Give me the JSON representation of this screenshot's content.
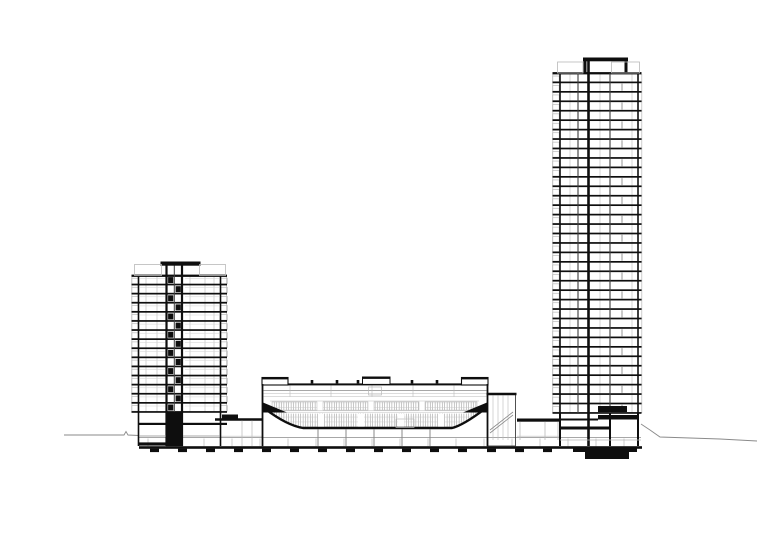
{
  "document": {
    "type": "architectural-cross-section",
    "description": "Black line architectural section drawing: a 15-storey residential tower (left) and a 36-storey residential tower (right) flanking a central arena auditorium with raked seating bowl, all on a shared podium with basement levels and footings; thin grade lines extend left and right.",
    "background": "#ffffff"
  },
  "palette": {
    "ink": "#0e0e0e",
    "dark": "#3d3d3d",
    "medium": "#8a8a8a",
    "light": "#b9b9b9",
    "faint": "#d2d2d2",
    "paper": "#ffffff"
  },
  "canvas": {
    "width": 780,
    "height": 546
  },
  "drawing": {
    "ground_left": {
      "points": [
        [
          64,
          435
        ],
        [
          100,
          435
        ],
        [
          124,
          435
        ],
        [
          126,
          431.5
        ],
        [
          128,
          435
        ],
        [
          139,
          435.5
        ]
      ]
    },
    "ground_right": {
      "points": [
        [
          641,
          424
        ],
        [
          650,
          430
        ],
        [
          660,
          437
        ],
        [
          690,
          438
        ],
        [
          720,
          439
        ],
        [
          757,
          441
        ]
      ]
    },
    "foundation": {
      "basement_line": [
        139,
        437.5,
        641,
        437.5
      ],
      "slab": [
        139,
        446.2,
        503,
        2.6
      ],
      "footing_xs": [
        150,
        178,
        206,
        234,
        262,
        290,
        318,
        346,
        374,
        402,
        430,
        458,
        487,
        515,
        543
      ],
      "footing_y": 448.6,
      "footing_w": 9,
      "footing_h": 3.5,
      "column_xs": [
        148,
        176,
        204,
        232,
        260,
        288,
        316,
        344,
        372,
        400,
        428,
        456,
        484,
        512,
        540,
        568,
        596,
        624
      ],
      "column_top": 438.5,
      "column_bot": 446.2
    },
    "left_tower": {
      "wall_l": 138.5,
      "wall_r": 220.5,
      "slab_x1": 131.5,
      "slab_x2": 227,
      "roof_y": 275.5,
      "base_y": 412,
      "floors": 15,
      "guard_x": [
        131.9,
        226.5
      ],
      "balcony_box": {
        "w": 6.6,
        "h": 5.6,
        "lx": 131.7,
        "rx": 220.7
      },
      "core": {
        "x1": 166.5,
        "x2": 182,
        "mid": 174.3,
        "top_y": 261.5,
        "cap": [
          160.5,
          261.5,
          40,
          4.2
        ]
      },
      "parapets": [
        [
          134.5,
          264.5,
          27,
          11
        ],
        [
          199.5,
          264.5,
          26,
          11
        ]
      ],
      "mullions": [
        146,
        157,
        190,
        205,
        214
      ],
      "window_line": {
        "x1": 185,
        "x2": 219,
        "dy": 3.1
      },
      "mezz_slab": [
        139,
        422.8,
        88,
        2.2
      ],
      "ground_line": [
        139,
        436,
        220,
        436
      ],
      "base_core_block": [
        166,
        412,
        17,
        34.2
      ],
      "base_slab_block": [
        139,
        442.4,
        33,
        3.2
      ]
    },
    "right_tower": {
      "wall_l": 560,
      "wall_r": 638,
      "slab_x1": 552.5,
      "slab_x2": 641.5,
      "roof_y": 73,
      "base_y": 413,
      "floors": 36,
      "guard_x": [
        552.8,
        641.8
      ],
      "balcony_box": {
        "w": 6.6,
        "h": 5.6,
        "lx": 552.6
      },
      "core_x": 588.5,
      "walls_thin": [
        578,
        610
      ],
      "mullions": [
        570,
        600,
        632
      ],
      "segment_wall_x": 622,
      "core_cap": [
        583,
        57.5,
        45,
        3.8
      ],
      "cap_posts": [
        [
          583.5,
          61,
          3,
          12
        ],
        [
          624.5,
          61,
          3,
          12
        ]
      ],
      "parapets": [
        [
          557.5,
          62,
          25.5,
          11
        ],
        [
          611.5,
          62,
          28,
          11
        ]
      ],
      "base": {
        "chunk1": [
          598,
          406,
          29,
          6
        ],
        "chunk2": [
          598,
          415,
          40,
          4.5
        ],
        "lowband": [
          560,
          426.5,
          50,
          3
        ],
        "edge_line": [
          560,
          419.5,
          598,
          419.5
        ],
        "walls_x": [
          560,
          588.5,
          610,
          638
        ],
        "ground_line": [
          560,
          440,
          641,
          440
        ]
      },
      "mats": {
        "outer": [
          573,
          446.5,
          64,
          5.5
        ],
        "inner": [
          585,
          451.5,
          44,
          7.5
        ]
      }
    },
    "arena": {
      "wall_l": 262.5,
      "wall_r": 487.5,
      "wall_top": 384,
      "wall_bot": 446.2,
      "roof_slab": [
        262,
        383.4,
        226,
        2
      ],
      "blocks": [
        [
          262,
          377.5,
          26,
          7.5
        ],
        [
          461.5,
          377.5,
          26.5,
          7.5
        ]
      ],
      "monitor": [
        362.5,
        377,
        27.5,
        7.4
      ],
      "monitor_box": [
        368.5,
        387,
        13,
        8
      ],
      "posts": [
        312,
        337,
        358,
        412,
        437
      ],
      "post_w": 2.6,
      "post_h": 3.4,
      "ceiling_ys": [
        390.5,
        393.4,
        396.6
      ],
      "hanger_xs": [
        290,
        331,
        372,
        413,
        454
      ],
      "tier": {
        "y": 401.8,
        "h": 8.3,
        "segments": [
          [
            272,
            317
          ],
          [
            323,
            368
          ],
          [
            374,
            419
          ],
          [
            425,
            477
          ]
        ]
      },
      "gallery_y": 412.2,
      "bowl": {
        "x1": 265,
        "x2": 485,
        "top_y": 408,
        "shelf_y": 413.6,
        "floor_y": 427.6,
        "floor_x1": 303,
        "floor_x2": 452
      },
      "vomitories": [
        318,
        358,
        398,
        438
      ],
      "wedges": [
        [
          [
            263,
            402.5
          ],
          [
            287,
            412.5
          ],
          [
            263,
            412.5
          ]
        ],
        [
          [
            487,
            402.5
          ],
          [
            463,
            412.5
          ],
          [
            487,
            412.5
          ]
        ]
      ],
      "floor_box": [
        396,
        419,
        18,
        8.4
      ],
      "under_cols": [
        318,
        346,
        374,
        402,
        430
      ]
    },
    "podium": {
      "left_roof": [
        215,
        419.5,
        263,
        419.5
      ],
      "left_block": [
        222,
        414.5,
        16,
        4
      ],
      "left_cols": [
        242,
        252
      ],
      "stair_tower": {
        "x1": 487.5,
        "x2": 515.5,
        "roof_y": 393.5,
        "rails": [
          493,
          498,
          503,
          508
        ],
        "diag": [
          [
            490,
            430,
            513,
            412
          ],
          [
            490,
            433,
            513,
            415
          ]
        ]
      },
      "canopy": [
        517,
        418.5,
        43,
        3.2
      ],
      "canopy_cols": [
        520,
        545,
        558
      ],
      "mid_ground_y": 436.2
    }
  }
}
